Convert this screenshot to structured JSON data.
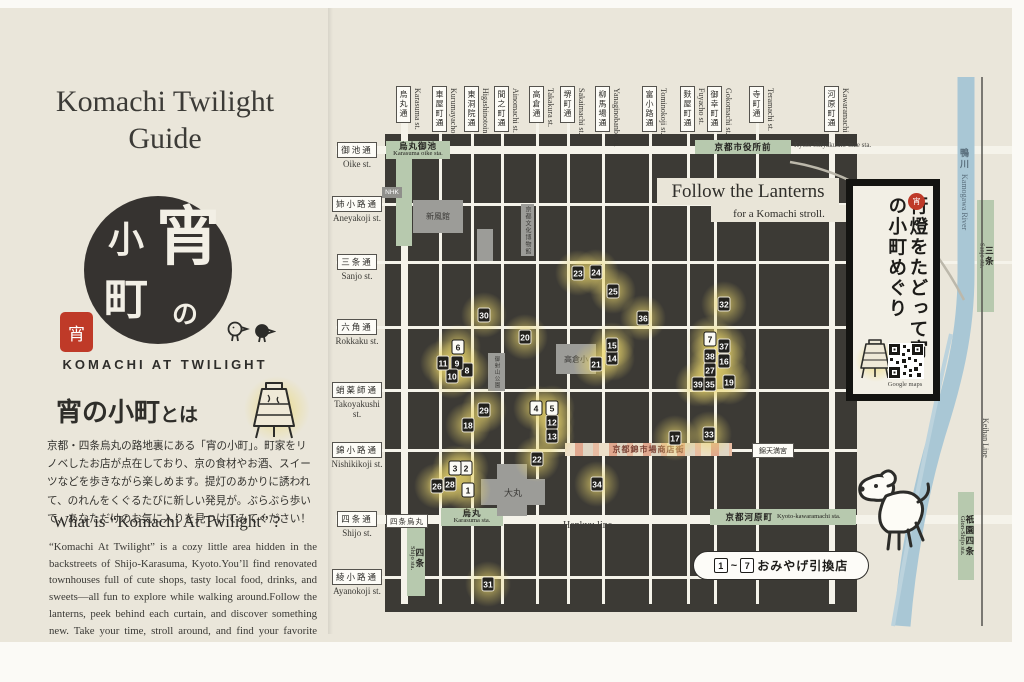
{
  "left_panel": {
    "title": "Komachi Twilight Guide",
    "logo": {
      "yoi": "宵",
      "no": "の",
      "ko": "小",
      "machi": "町",
      "seal": "宵"
    },
    "logo_subtitle": "KOMACHI AT TWILIGHT",
    "about_heading_main": "宵の小町",
    "about_heading_suffix": "とは",
    "about_body": "京都・四条烏丸の路地裏にある「宵の小町」。町家をリノベしたお店が点在しており、京の食材やお酒、スイーツなどを歩きながら楽しめます。提灯のあかりに誘われて、のれんをくぐるたびに新しい発見が。ぶらぶら歩いて、あなただけのお気に入りを見つけてみてください！",
    "what_heading": "What is “Komachi At Twilight” ?",
    "what_body": "“Komachi At Twilight” is a cozy little area hidden in the backstreets of Shijo-Karasuma, Kyoto.You’ll find renovated townhouses full of cute shops, tasty local food, drinks, and sweets—all fun to explore while walking around.Follow the lanterns, peek behind each curtain, and discover something new. Take your time, stroll around, and find your favorite spots!"
  },
  "map": {
    "follow_title": "Follow the Lanterns",
    "follow_sub": "for a Komachi stroll.",
    "banner": {
      "text": "行燈をたどって宵の小町めぐり",
      "seal": "宵",
      "qr_caption": "Google maps"
    },
    "legend": {
      "range_start": "1",
      "range_sep": "~",
      "range_end": "7",
      "label": "おみやげ引換店"
    },
    "hankyu_label": "Hankyu line",
    "keihan_label": "Keihan Line",
    "river_jp": "鴨川",
    "river_en": "Kamogawa River",
    "nhk_label": "NHK",
    "shijo_karasuma_label": "四条烏丸",
    "nishiki_label": "京都錦市場商店街",
    "tenmangu_label": "錦天満宮",
    "vertical_streets": [
      {
        "jp": "烏丸通",
        "romaji": "Karasuma st.",
        "x": 404,
        "w": 7
      },
      {
        "jp": "車屋町通",
        "romaji": "Kurumayacho st.",
        "x": 440,
        "w": 3
      },
      {
        "jp": "東洞院通",
        "romaji": "Higashinotoin st.",
        "x": 472,
        "w": 3
      },
      {
        "jp": "間之町通",
        "romaji": "Ainomachi st.",
        "x": 502,
        "w": 3
      },
      {
        "jp": "高倉通",
        "romaji": "Takakura st.",
        "x": 537,
        "w": 3
      },
      {
        "jp": "堺町通",
        "romaji": "Sakaimachi st.",
        "x": 568,
        "w": 3
      },
      {
        "jp": "柳馬場通",
        "romaji": "Yanaginobanba st.",
        "x": 603,
        "w": 3
      },
      {
        "jp": "富小路通",
        "romaji": "Tominokoji st.",
        "x": 650,
        "w": 3
      },
      {
        "jp": "麩屋町通",
        "romaji": "Fuyacho st.",
        "x": 688,
        "w": 3
      },
      {
        "jp": "御幸町通",
        "romaji": "Gokomachi st.",
        "x": 715,
        "w": 3
      },
      {
        "jp": "寺町通",
        "romaji": "Teramachi st.",
        "x": 757,
        "w": 3
      },
      {
        "jp": "河原町通",
        "romaji": "Kawaramachi st.",
        "x": 832,
        "w": 6
      }
    ],
    "horizontal_streets": [
      {
        "jp": "御池通",
        "romaji": "Oike st.",
        "y": 158,
        "w": 8,
        "x2": 1012
      },
      {
        "jp": "姉小路通",
        "romaji": "Aneyakoji st.",
        "y": 212,
        "w": 3,
        "x2": 857
      },
      {
        "jp": "三条通",
        "romaji": "Sanjo st.",
        "y": 270,
        "w": 3,
        "x2": 1012
      },
      {
        "jp": "六角通",
        "romaji": "Rokkaku st.",
        "y": 335,
        "w": 3,
        "x2": 857
      },
      {
        "jp": "蛸薬師通",
        "romaji": "Takoyakushi st.",
        "y": 398,
        "w": 3,
        "x2": 857
      },
      {
        "jp": "錦小路通",
        "romaji": "Nishikikoji st.",
        "y": 458,
        "w": 3,
        "x2": 857
      },
      {
        "jp": "四条通",
        "romaji": "Shijo st.",
        "y": 527,
        "w": 9,
        "x2": 1012
      },
      {
        "jp": "綾小路通",
        "romaji": "Ayanokoji st.",
        "y": 585,
        "w": 3,
        "x2": 857
      }
    ],
    "stations": [
      {
        "jp": "烏丸御池",
        "romaji": "Karasuma oike sta.",
        "x": 386,
        "y": 149,
        "w": 64,
        "h": 18,
        "dir": "h"
      },
      {
        "jp": "京都市役所前",
        "romaji": "Kyoto Shiyakusho-mae sta.",
        "x": 695,
        "y": 148,
        "w": 96,
        "h": 14,
        "dir": "h",
        "outside": true
      },
      {
        "jp": "烏丸",
        "romaji": "Karasuma sta.",
        "x": 441,
        "y": 516,
        "w": 62,
        "h": 18,
        "dir": "h"
      },
      {
        "jp": "京都河原町",
        "romaji": "Kyoto-kawaramachi sta.",
        "x": 710,
        "y": 517,
        "w": 146,
        "h": 16,
        "dir": "h",
        "inline": true
      },
      {
        "jp": "四条",
        "romaji": "Shijo sta.",
        "x": 407,
        "y": 528,
        "w": 18,
        "h": 76,
        "dir": "v"
      },
      {
        "jp": "三条",
        "romaji": "Sanjo sta.",
        "x": 977,
        "y": 208,
        "w": 17,
        "h": 112,
        "dir": "v"
      },
      {
        "jp": "祇園四条",
        "romaji": "Gion-Shijo sta.",
        "x": 958,
        "y": 500,
        "w": 16,
        "h": 88,
        "dir": "v"
      }
    ],
    "buildings": [
      {
        "label": "",
        "x": 497,
        "y": 472,
        "w": 30,
        "h": 52,
        "fs": 8
      },
      {
        "label": "新風館",
        "x": 413,
        "y": 208,
        "w": 50,
        "h": 33,
        "fs": 8
      },
      {
        "label": "",
        "x": 477,
        "y": 237,
        "w": 16,
        "h": 32,
        "fs": 8
      },
      {
        "label": "京都文化博物館",
        "x": 521,
        "y": 212,
        "w": 13,
        "h": 52,
        "fs": 6,
        "vert": true
      },
      {
        "label": "高倉小",
        "x": 556,
        "y": 352,
        "w": 40,
        "h": 30,
        "fs": 8
      },
      {
        "label": "御射山公園",
        "x": 488,
        "y": 361,
        "w": 17,
        "h": 38,
        "fs": 5.5,
        "vert": true
      },
      {
        "label": "大丸",
        "x": 481,
        "y": 487,
        "w": 64,
        "h": 26,
        "fs": 9
      }
    ],
    "markers": [
      {
        "n": 1,
        "x": 468,
        "y": 498,
        "t": "w"
      },
      {
        "n": 2,
        "x": 466,
        "y": 476,
        "t": "w"
      },
      {
        "n": 3,
        "x": 455,
        "y": 476,
        "t": "w"
      },
      {
        "n": 4,
        "x": 536,
        "y": 416,
        "t": "w"
      },
      {
        "n": 5,
        "x": 552,
        "y": 416,
        "t": "w"
      },
      {
        "n": 6,
        "x": 458,
        "y": 355,
        "t": "w"
      },
      {
        "n": 7,
        "x": 710,
        "y": 347,
        "t": "w"
      },
      {
        "n": 8,
        "x": 467,
        "y": 378,
        "t": "b"
      },
      {
        "n": 9,
        "x": 457,
        "y": 371,
        "t": "b"
      },
      {
        "n": 10,
        "x": 452,
        "y": 384,
        "t": "b"
      },
      {
        "n": 11,
        "x": 443,
        "y": 371,
        "t": "b"
      },
      {
        "n": 12,
        "x": 552,
        "y": 430,
        "t": "b"
      },
      {
        "n": 13,
        "x": 552,
        "y": 444,
        "t": "b"
      },
      {
        "n": 14,
        "x": 612,
        "y": 366,
        "t": "b"
      },
      {
        "n": 15,
        "x": 612,
        "y": 353,
        "t": "b"
      },
      {
        "n": 16,
        "x": 724,
        "y": 369,
        "t": "b"
      },
      {
        "n": 17,
        "x": 675,
        "y": 446,
        "t": "b"
      },
      {
        "n": 18,
        "x": 468,
        "y": 433,
        "t": "b"
      },
      {
        "n": 19,
        "x": 729,
        "y": 390,
        "t": "b"
      },
      {
        "n": 20,
        "x": 525,
        "y": 345,
        "t": "b"
      },
      {
        "n": 21,
        "x": 596,
        "y": 372,
        "t": "b"
      },
      {
        "n": 22,
        "x": 537,
        "y": 467,
        "t": "b"
      },
      {
        "n": 23,
        "x": 578,
        "y": 281,
        "t": "b"
      },
      {
        "n": 24,
        "x": 596,
        "y": 280,
        "t": "b"
      },
      {
        "n": 25,
        "x": 613,
        "y": 299,
        "t": "b"
      },
      {
        "n": 26,
        "x": 437,
        "y": 494,
        "t": "b"
      },
      {
        "n": 27,
        "x": 710,
        "y": 378,
        "t": "b"
      },
      {
        "n": 28,
        "x": 450,
        "y": 492,
        "t": "b"
      },
      {
        "n": 29,
        "x": 484,
        "y": 418,
        "t": "b"
      },
      {
        "n": 30,
        "x": 484,
        "y": 323,
        "t": "b"
      },
      {
        "n": 31,
        "x": 488,
        "y": 592,
        "t": "b"
      },
      {
        "n": 32,
        "x": 724,
        "y": 312,
        "t": "b"
      },
      {
        "n": 33,
        "x": 709,
        "y": 442,
        "t": "b"
      },
      {
        "n": 34,
        "x": 597,
        "y": 492,
        "t": "b"
      },
      {
        "n": 35,
        "x": 710,
        "y": 392,
        "t": "b"
      },
      {
        "n": 36,
        "x": 643,
        "y": 326,
        "t": "b"
      },
      {
        "n": 37,
        "x": 724,
        "y": 354,
        "t": "b"
      },
      {
        "n": 38,
        "x": 710,
        "y": 364,
        "t": "b"
      },
      {
        "n": 39,
        "x": 698,
        "y": 392,
        "t": "b"
      }
    ]
  }
}
